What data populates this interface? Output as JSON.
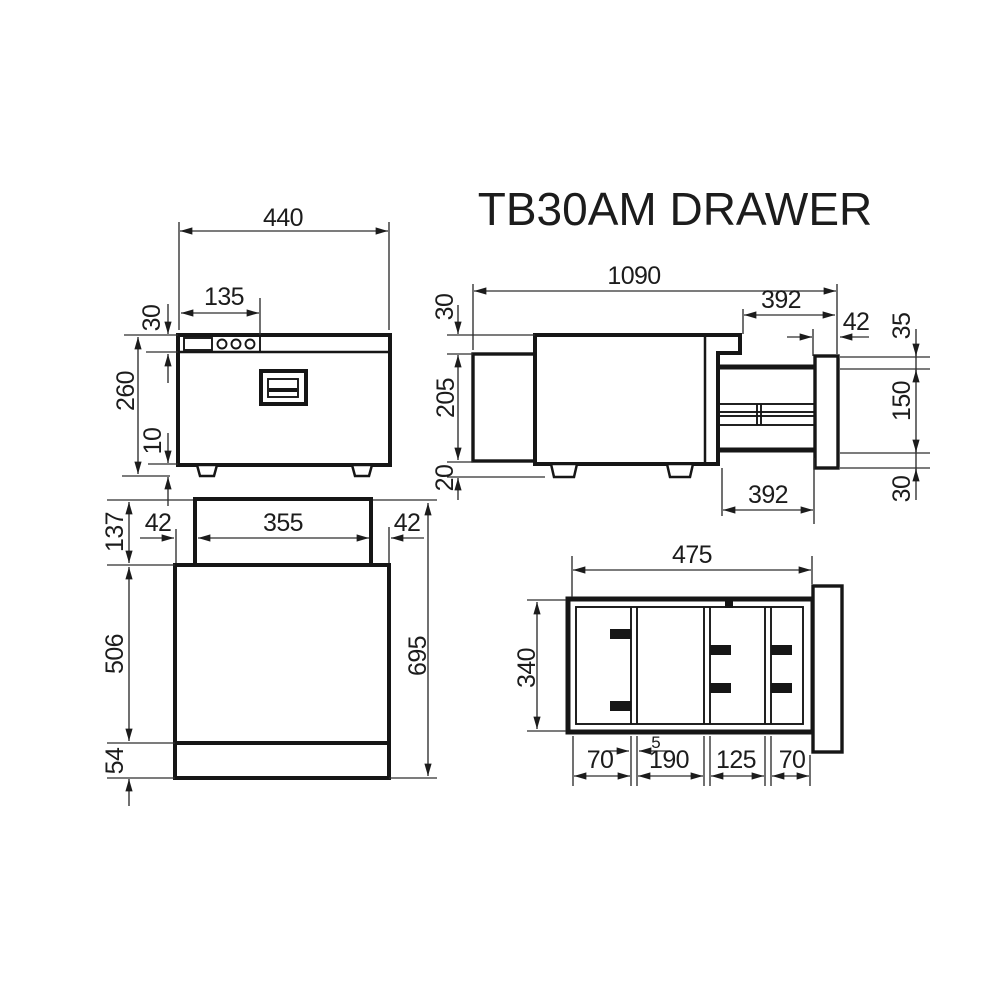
{
  "title": "TB30AM DRAWER",
  "units": "mm",
  "views": {
    "front": {
      "name": "front view",
      "dims": {
        "width": "440",
        "control_panel": "135",
        "top_band": "30",
        "height": "260",
        "foot": "10"
      }
    },
    "side": {
      "name": "side view drawer extended",
      "dims": {
        "length": "1090",
        "slide_extension_top": "392",
        "front_clearance": "42",
        "front_above": "35",
        "top_recess": "30",
        "body_height": "205",
        "drawer_front": "150",
        "foot": "20",
        "slide_extension_bottom": "392",
        "front_below": "30"
      }
    },
    "plan": {
      "name": "top view",
      "dims": {
        "rear_section": "137",
        "left_inset": "42",
        "rear_cutout": "355",
        "right_inset": "42",
        "body_depth": "506",
        "front_strip": "54",
        "total_depth": "695"
      }
    },
    "drawer": {
      "name": "drawer interior view",
      "dims": {
        "width": "475",
        "depth": "340",
        "compartment_1": "70",
        "divider": "5",
        "compartment_2": "190",
        "compartment_3": "125",
        "compartment_4": "70"
      }
    }
  }
}
